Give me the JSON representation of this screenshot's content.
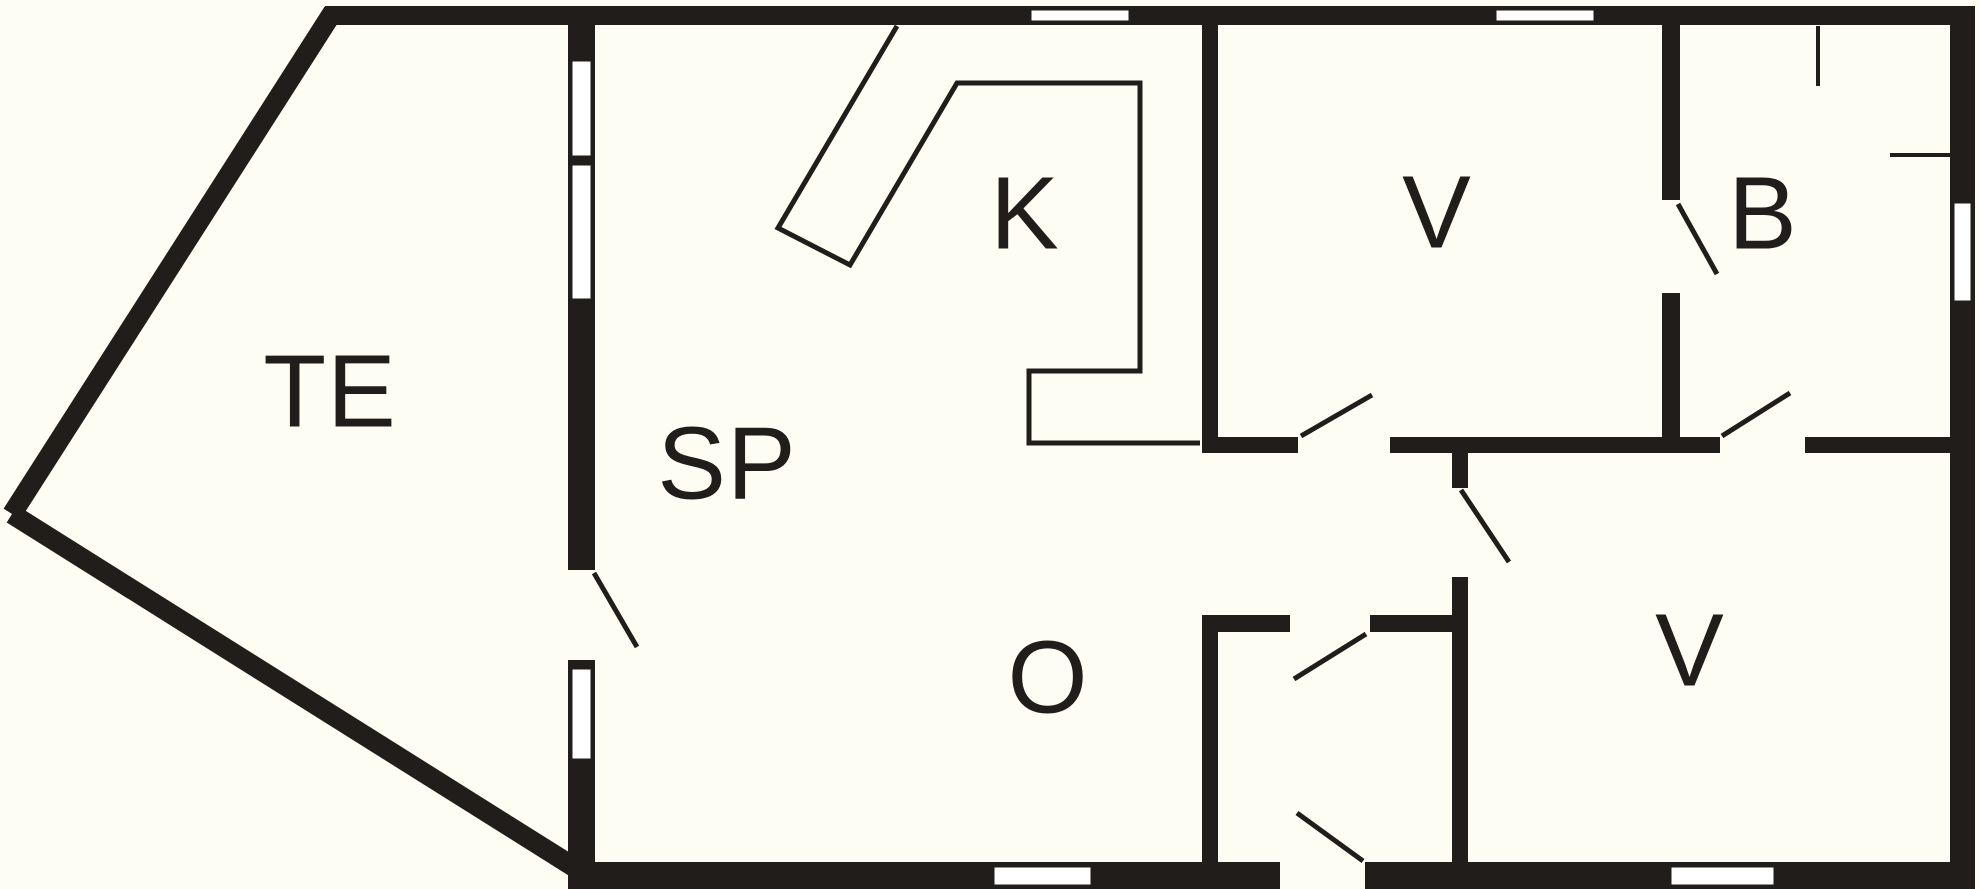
{
  "plan": {
    "type": "floor-plan",
    "colors": {
      "paper": "#FDFDF4",
      "ink": "#201D1A",
      "window_fill": "#FFFFFF"
    },
    "rooms": [
      {
        "id": "terrace",
        "label": "TE"
      },
      {
        "id": "living-room",
        "label": "SP"
      },
      {
        "id": "kitchen",
        "label": "K"
      },
      {
        "id": "bedroom-top",
        "label": "V"
      },
      {
        "id": "bathroom",
        "label": "B"
      },
      {
        "id": "hall",
        "label": "O"
      },
      {
        "id": "bedroom-bottom",
        "label": "V"
      }
    ]
  }
}
